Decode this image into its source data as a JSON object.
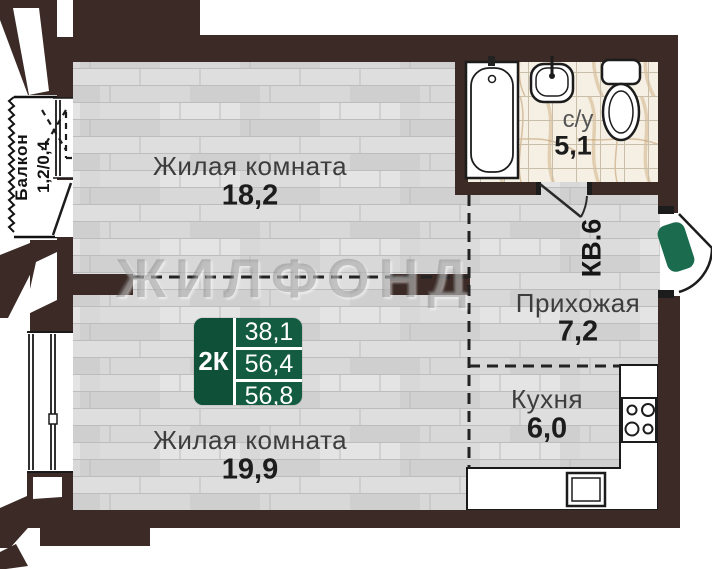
{
  "plan": {
    "watermark": "ЖИЛФОНД",
    "entrance_label": "КВ.6",
    "badge": {
      "type": "2К",
      "living_area": "38,1",
      "area": "56,4",
      "total_area": "56,8"
    },
    "rooms": {
      "living1": {
        "name": "Жилая комната",
        "area": "18,2"
      },
      "living2": {
        "name": "Жилая комната",
        "area": "19,9"
      },
      "hallway": {
        "name": "Прихожая",
        "area": "7,2"
      },
      "kitchen": {
        "name": "Кухня",
        "area": "6,0"
      },
      "bathroom": {
        "name": "с/у",
        "area": "5,1"
      },
      "balcony": {
        "name": "Балкон",
        "area": "1,2/0,4"
      }
    },
    "colors": {
      "wall": "#3B2A25",
      "door_green": "#1B6B4F",
      "badge_green": "#135C42",
      "wood_floor": "#D8D8D8",
      "marble": "#F5EFE4"
    }
  }
}
